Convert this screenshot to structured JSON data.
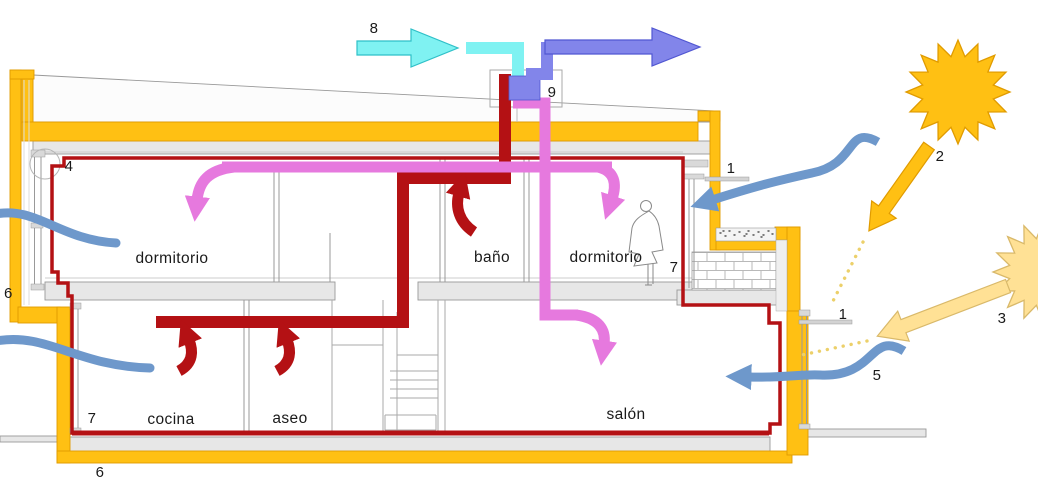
{
  "rooms": {
    "dormitorio_left": "dormitorio",
    "banio": "baño",
    "dormitorio_right": "dormitorio",
    "cocina": "cocina",
    "aseo": "aseo",
    "salon": "salón"
  },
  "callouts": {
    "n1": "1",
    "n2": "2",
    "n3": "3",
    "n4": "4",
    "n5": "5",
    "n6": "6",
    "n7": "7",
    "n8": "8",
    "n9": "9"
  },
  "colors": {
    "insulation_yellow": "#ffc013",
    "insulation_stroke": "#e09b00",
    "exhaust_red": "#b41114",
    "supply_magenta": "#e679de",
    "fresh_cyan": "#7ff2f2",
    "fresh_cyan_stroke": "#2fc0c8",
    "extract_violet": "#8285ea",
    "extract_violet_stroke": "#5157d2",
    "wind_blue": "#6e98cb",
    "sun_orange": "#ffc013",
    "sun_pale": "#ffe195",
    "sun_pale_stroke": "#d9b96a",
    "dotted_ray": "#ecd06a",
    "structure_gray": "#e7e7e7",
    "line_gray": "#999999"
  }
}
